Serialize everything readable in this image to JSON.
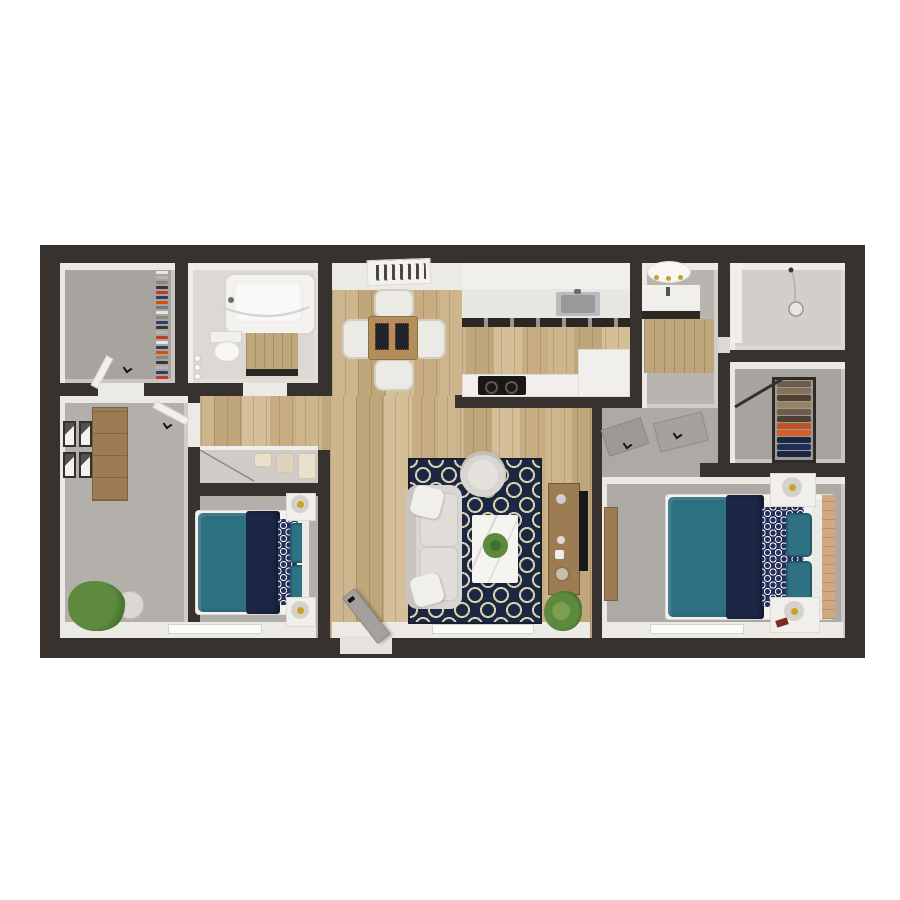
{
  "scene": {
    "kind": "3d-rendered-floor-plan",
    "description": "Top-down 3D render of a two-bedroom, two-bath apartment floor plan on a white background",
    "background": "#ffffff"
  },
  "palette": {
    "wall": "#37322d",
    "wallFace": "#eceae5",
    "woodA": "#cdb68e",
    "woodB": "#c0a67b",
    "woodC": "#d5bf98",
    "carpet1": "#b3b0ac",
    "carpet2": "#adaaa6",
    "closetFloor": "#a7a4a0",
    "tile": "#b8b5b1",
    "bathFloor": "#dcd8d3",
    "showerFloor": "#d2cfca",
    "counter": "#f1efec",
    "counterTop": "#e9e7e2",
    "counterDark": "#2b2723",
    "steel": "#b9bcbe",
    "steelDark": "#97999b",
    "tableWood": "#b28e5a",
    "furnWood": "#a5straight",
    "dresserWood": "#9c7c52",
    "headboardWood": "#d2a87e",
    "teal": "#2e7183",
    "tealDark": "#245b6b",
    "navy": "#1c2746",
    "patNavy": "#25305a",
    "cream": "#d9d2a8",
    "sofa": "#d9d6d2",
    "sofaBack": "#c8c5c0",
    "cushion": "#e0ddd9",
    "white": "#f5f4f1",
    "green": "#5d8a3e",
    "greenDark": "#44702d",
    "pot": "#dbd8d4",
    "lampRim": "#d5d2cd",
    "lampGold": "#c9a227",
    "doorGray": "#a4a19d",
    "doorEdge": "#8d8a86",
    "chair": "#eceae5",
    "linen": "#e9e1cd",
    "tvBlack": "#16181a"
  },
  "rooms": [
    {
      "name": "walk-in-closet-1",
      "floor": "gray",
      "contents": [
        "hanging-clothes-rack",
        "door"
      ]
    },
    {
      "name": "bathroom-1",
      "floor": "light-tile",
      "contents": [
        "bathtub",
        "shower-curtain-rod",
        "toilet",
        "wood-vanity",
        "toiletries"
      ]
    },
    {
      "name": "dining-area",
      "floor": "wood",
      "contents": [
        "ceiling-vent",
        "dining-table",
        "placemats",
        "four-chairs"
      ]
    },
    {
      "name": "kitchen",
      "floor": "wood",
      "contents": [
        "upper-cabinets",
        "counter-with-sink",
        "dark-base-cabinets",
        "peninsula-counter",
        "cooktop"
      ]
    },
    {
      "name": "bathroom-2",
      "floor": "gray-tile",
      "contents": [
        "vanity-light",
        "vanity-sink",
        "wood-cabinet"
      ]
    },
    {
      "name": "shower-room",
      "floor": "light-tile",
      "contents": [
        "shower-head",
        "shower-hose",
        "glass-panel"
      ]
    },
    {
      "name": "walk-in-closet-2",
      "floor": "gray",
      "contents": [
        "shelf-unit-with-folded-clothes",
        "hanging-rod"
      ]
    },
    {
      "name": "bedroom-1",
      "floor": "carpet",
      "contents": [
        "bed-teal-navy",
        "two-nightstands-with-lamps",
        "dresser",
        "wall-art-frames",
        "plant",
        "linen-closet",
        "window"
      ]
    },
    {
      "name": "living-room",
      "floor": "wood",
      "contents": [
        "patterned-rug",
        "sofa",
        "round-accent-chair",
        "marble-coffee-table-with-plant",
        "media-console",
        "tv",
        "plant",
        "entry-door",
        "window"
      ]
    },
    {
      "name": "bedroom-2",
      "floor": "carpet",
      "contents": [
        "bed-teal-navy",
        "two-nightstands-with-lamps",
        "wood-dresser",
        "headboard-wood-panel",
        "window"
      ]
    }
  ],
  "closet1_hanging_colors": [
    "#e8e6e2",
    "#b9b5b0",
    "#8a8680",
    "#3a3632",
    "#c0392b",
    "#2c3e66",
    "#d35400",
    "#6b7a8c",
    "#e8e6e2",
    "#8a8680",
    "#2c3e66",
    "#3a3632",
    "#b9b5b0",
    "#c0392b",
    "#e8e6e2",
    "#2c3e66",
    "#d35400",
    "#8a8680",
    "#3a3632",
    "#b9b5b0",
    "#2c3e66",
    "#c0392b"
  ],
  "closet2_stack_colors": [
    "#6e5b49",
    "#857057",
    "#4e4134",
    "#9c8062",
    "#6e5b49",
    "#4e4134",
    "#bf5527",
    "#d35f2a",
    "#1c2746",
    "#232e54",
    "#1c2746"
  ],
  "art_frame_count": 4,
  "linen_stack_colors": [
    "#e9e1cd",
    "#ded4bc",
    "#e9e1cd"
  ],
  "counts": {
    "bedrooms": 2,
    "bathrooms": 2,
    "closets": 3,
    "dining_chairs": 4
  }
}
